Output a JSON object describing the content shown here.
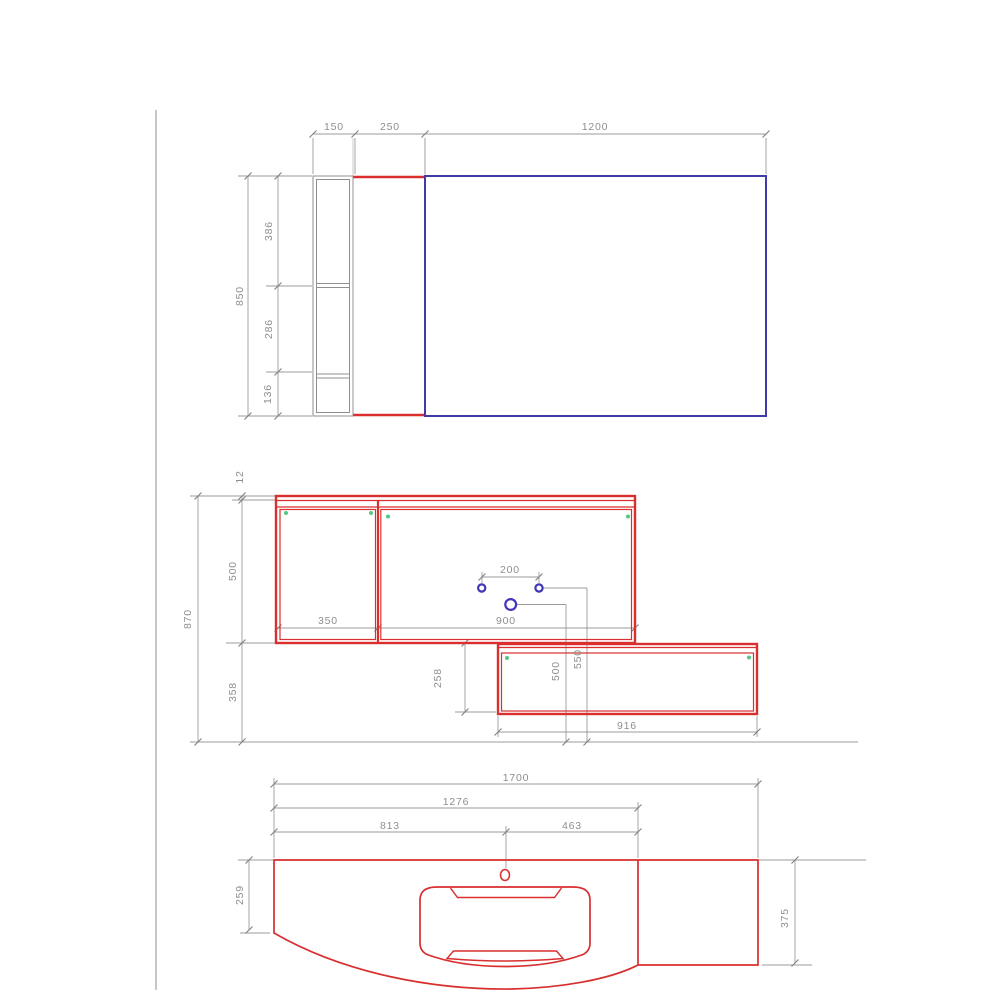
{
  "colors": {
    "red": "#d92f2f",
    "blue": "#423aa8",
    "hole_blue": "#4136b8",
    "green": "#57c785",
    "line_gray": "#9b9b9b",
    "struct_gray": "#8f8f8f",
    "text_gray": "#8e8e8e"
  },
  "views": {
    "plan": {
      "dim_side_cabinet_width": "150",
      "dim_mid_panel_width": "250",
      "dim_large_panel_width": "1200",
      "dim_total_depth": "850",
      "dim_shelf_seg_top": "386",
      "dim_shelf_seg_mid": "286",
      "dim_shelf_seg_bottom": "136"
    },
    "front": {
      "dim_top_strip": "12",
      "dim_upper_height": "500",
      "dim_lower_drop": "358",
      "dim_total_height": "870",
      "dim_left_door": "350",
      "dim_right_door": "900",
      "dim_tap_spacing": "200",
      "dim_tap_height_large": "500",
      "dim_tap_height_small": "550",
      "dim_lower_cabinet_height": "258",
      "dim_lower_cabinet_width": "916"
    },
    "counter": {
      "dim_total_width": "1700",
      "dim_to_divider": "1276",
      "dim_to_center": "813",
      "dim_center_to_divider": "463",
      "dim_left_depth": "259",
      "dim_right_depth": "375"
    }
  }
}
